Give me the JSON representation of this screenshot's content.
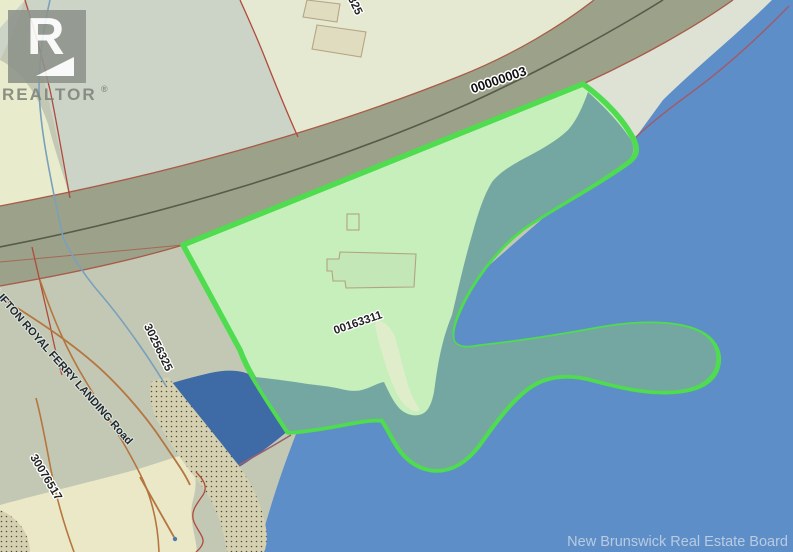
{
  "canvas": {
    "width": 793,
    "height": 552
  },
  "branding": {
    "logo_letter": "R",
    "logo_text": "REALTOR",
    "registered_mark": "®",
    "watermark": "New Brunswick Real Estate Board"
  },
  "labels": {
    "road_segment_id": "00000003",
    "highlighted_parcel_id": "00163311",
    "parcel_id_west": "30256325",
    "parcel_id_southwest": "30076517",
    "parcel_id_top_partial": "325",
    "road_name": "CLIFTON ROYAL FERRY LANDING Road"
  },
  "colors": {
    "water": "#5e8ec8",
    "cove_water": "#3e6ba6",
    "marsh_teal": "#74a7a1",
    "parcel_fill": "#c6efbc",
    "parcel_border": "#4fdc4f",
    "road_fill": "#9ca189",
    "land_base": "#c3c8b5",
    "land_upper_gray": "#ccd3c7",
    "land_pale_yellow": "#e8ebcc",
    "buildings_parcel": "#e6e9d1",
    "shore_strip": "#dde2d4",
    "beige_flat": "#ebe8c7",
    "stipple_base": "#d5d1b0",
    "boundary_red": "#b04a3a",
    "trail_brown": "#b5763f",
    "stream_blue": "#7aa0bc",
    "shore_boundary_mauve": "#9c5e6e"
  }
}
